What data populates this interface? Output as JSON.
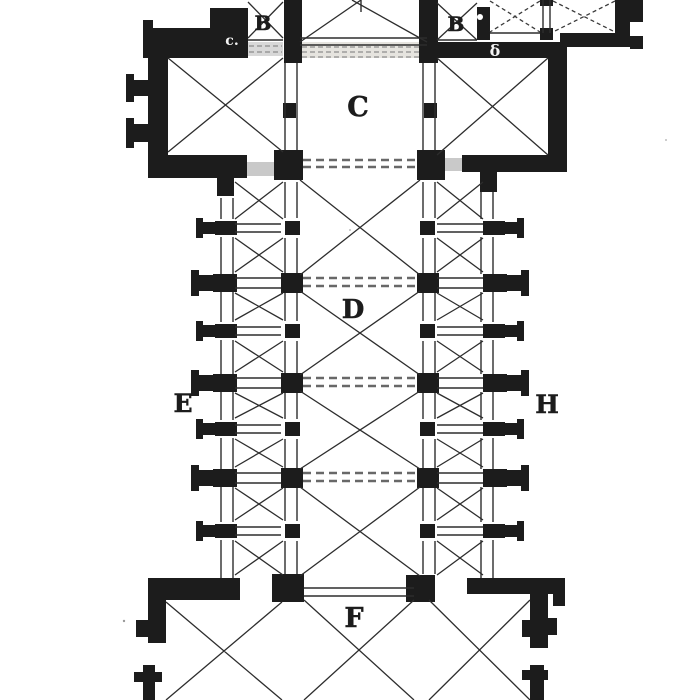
{
  "figure": {
    "type": "architectural-floor-plan",
    "subject": "Ground plan of a cruciform church (woodcut engraving, cropped top and bottom)",
    "style": "black ink on white paper"
  },
  "palette": {
    "paper": "#ffffff",
    "ink": "#1c1c1c",
    "line": "#2d2d2d",
    "hatch_light": "#e6e4df",
    "hatch_mid": "#d8d8d8",
    "hatch_dark": "#c9c9c9"
  },
  "plan": {
    "labels": [
      {
        "id": "chapel-b-left",
        "text": "B",
        "x": 263,
        "y": 30,
        "size": 20,
        "fill": "#1c1c1c"
      },
      {
        "id": "wall-mark-c",
        "text": "c.",
        "x": 232,
        "y": 45,
        "size": 14,
        "fill": "#f4f4f4"
      },
      {
        "id": "chapel-b-right",
        "text": "B",
        "x": 456,
        "y": 31,
        "size": 20,
        "fill": "#1c1c1c"
      },
      {
        "id": "wall-mark-delta",
        "text": "δ",
        "x": 495,
        "y": 56,
        "size": 16,
        "fill": "#f4f4f4"
      },
      {
        "id": "choir-c",
        "text": "C",
        "x": 358,
        "y": 116,
        "size": 27,
        "fill": "#1c1c1c"
      },
      {
        "id": "nave-d",
        "text": "D",
        "x": 353,
        "y": 318,
        "size": 26,
        "fill": "#1c1c1c"
      },
      {
        "id": "aisle-e",
        "text": "E",
        "x": 183,
        "y": 412,
        "size": 25,
        "fill": "#1c1c1c"
      },
      {
        "id": "aisle-h",
        "text": "H",
        "x": 547,
        "y": 413,
        "size": 25,
        "fill": "#1c1c1c"
      },
      {
        "id": "westwork-f",
        "text": "F",
        "x": 354,
        "y": 627,
        "size": 27,
        "fill": "#1c1c1c"
      }
    ]
  }
}
